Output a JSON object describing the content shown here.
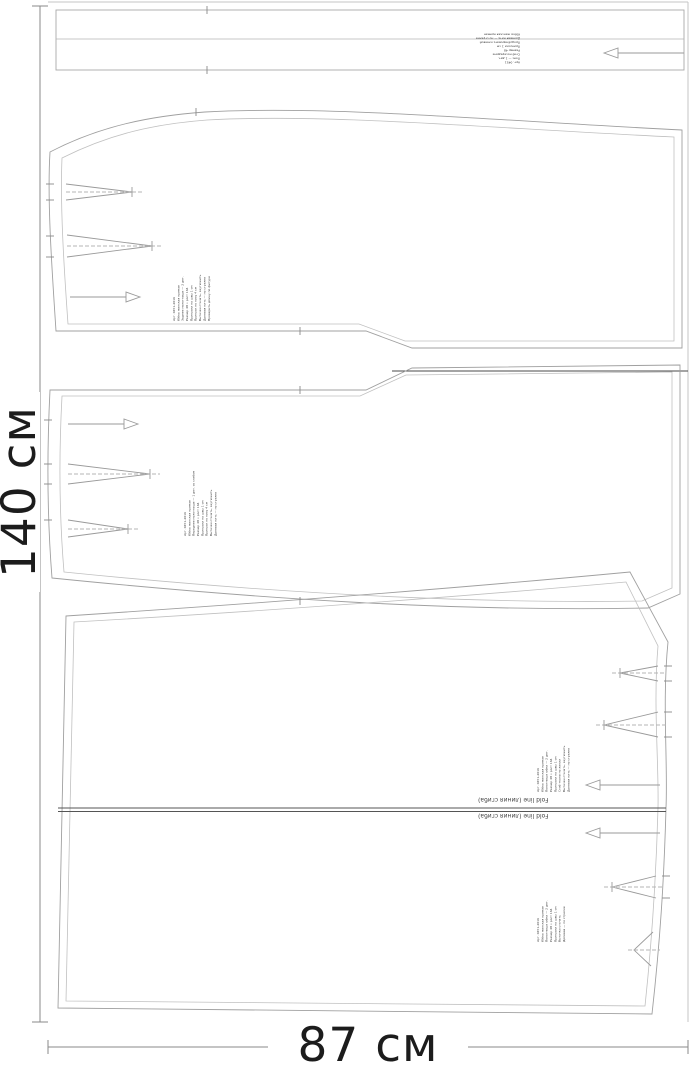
{
  "dimensions": {
    "height_label": "140 см",
    "width_label": "87 см"
  },
  "fold_line": {
    "label_top": "Fold line (линия сгиба)",
    "label_bottom": "Fold line (линия сгиба)"
  },
  "waistband": {
    "info_lines": [
      "Арт. 0451",
      "Пояс — 1 дет.",
      "Сгиб посередине",
      "Размер 48",
      "Припуски 1 см",
      "Продублировать клеевой",
      "Долевая нить — по стрелке",
      "Юбка женская прямая"
    ]
  },
  "piece_upper": {
    "info_lines": [
      "Арт. 0451-2016",
      "Юбка женская прямая",
      "Заднее полотнище — 2 дет.",
      "Размер 48 • рост 164",
      "Припуски на швы 1 см",
      "Припуск по низу 4 см",
      "Вытачки стачать, заутюжить",
      "Долевая нить — по стрелке",
      "Проверить длину по фигуре"
    ]
  },
  "piece_middle": {
    "info_lines": [
      "Арт. 0451-2016",
      "Юбка женская прямая",
      "Переднее полотнище — 1 дет. со сгибом",
      "Размер 48 • рост 164",
      "Припуски на швы 1 см",
      "Припуск по низу 4 см",
      "Вытачки стачать, заутюжить",
      "Долевая нить — по стрелке"
    ]
  },
  "piece_bottom": {
    "info_lines_1": [
      "Арт. 0451-2016",
      "Юбка женская прямая",
      "Полотнище юбки — 2 дет.",
      "Размер 48 • рост 164",
      "Припуски на швы 1 см",
      "Сгиб ткани по линии",
      "Вытачки стачать, заутюжить",
      "Долевая нить — по стрелке"
    ],
    "info_lines_2": [
      "Арт. 0451-2016",
      "Юбка женская прямая",
      "Полотнище юбки — 2 дет.",
      "Размер 48 • рост 164",
      "Припуски на швы 1 см",
      "Вытачки стачать",
      "Долевая — по стрелке"
    ]
  },
  "colors": {
    "outline": "#a8a8a8",
    "inner_line": "#bdbdbd",
    "dark_line": "#4a4a4a",
    "text": "#1c1c1c"
  }
}
